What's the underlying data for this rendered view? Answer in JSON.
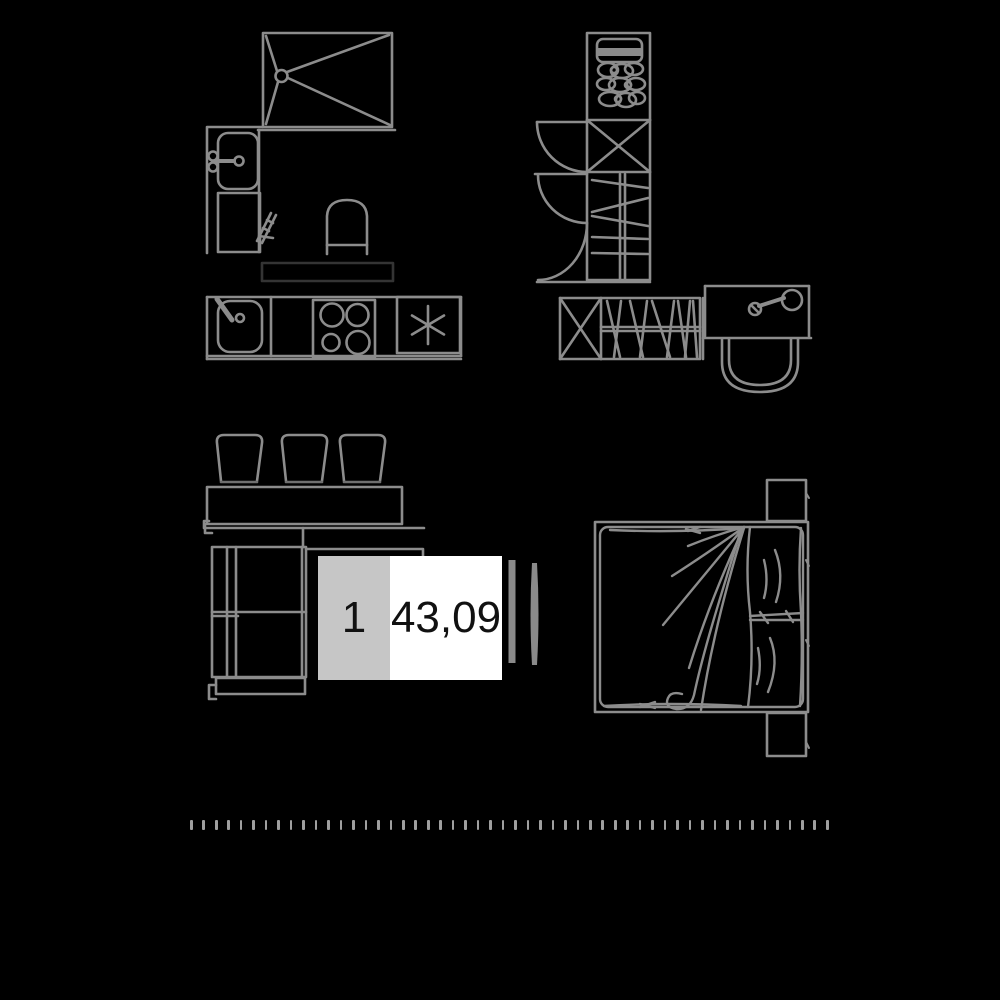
{
  "unit_card": {
    "number": "1",
    "area": "43,09"
  },
  "colors": {
    "bg": "#000000",
    "line": "#8c8c8c",
    "line_dim": "#6f6f6f",
    "dark_outline": "#343434",
    "unit_number_bg": "#c6c6c6",
    "area_bg": "#ffffff",
    "text": "#111111",
    "tick": "#9f9f9f"
  },
  "scale_bar": {
    "tick_count": 52
  },
  "fixtures": [
    "shower-tray-icon",
    "washbasin-icon",
    "bathroom-cabinet-icon",
    "towel-rail-icon",
    "toilet-icon",
    "worktop-outline",
    "kitchen-sink-icon",
    "cooktop-icon",
    "fridge-snowflake-icon",
    "tall-wardrobe-icon",
    "linen-rolls-icon",
    "door-swing-arc",
    "low-wardrobe-hangers-icon",
    "washstand-faucet-icon",
    "washstand-basin-icon",
    "storage-boxes-icon",
    "shelf-counter-icon",
    "corner-sofa-icon",
    "door-panel-bars",
    "double-bed-icon",
    "pillows-icon",
    "duvet-folds-icon"
  ]
}
